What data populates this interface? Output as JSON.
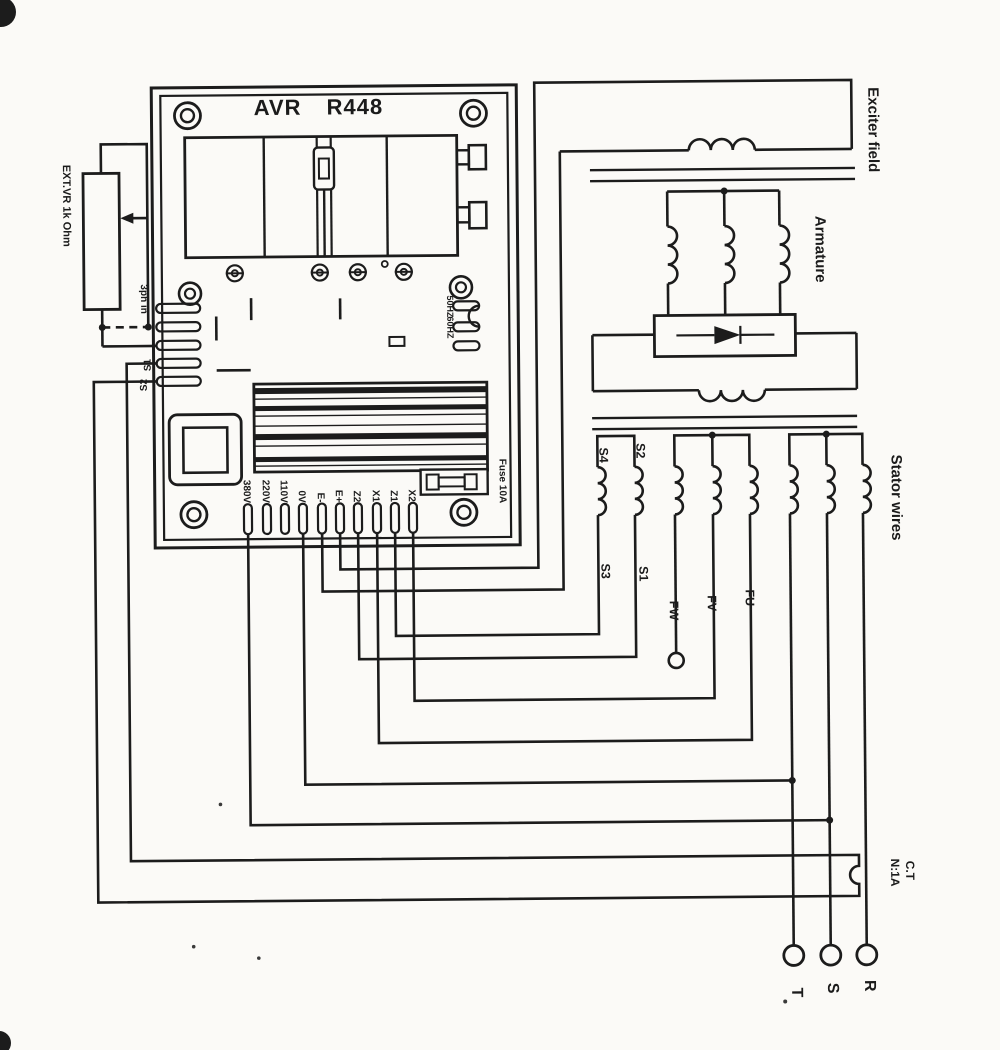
{
  "board": {
    "title": "AVR R448",
    "ext_vr_label": "EXT.VR 1k Ohm",
    "ph_in_label": "3ph in",
    "ct_s1_label": "S1",
    "ct_s2_label": "S2",
    "freq_50": "50HZ",
    "freq_60": "60HZ",
    "fuse_label": "Fuse 10A",
    "bottom_terminals": [
      "380V",
      "220V",
      "110V",
      "0V",
      "E-",
      "E+",
      "Z2",
      "X1",
      "Z1",
      "X2"
    ]
  },
  "generator": {
    "exciter_field_label": "Exciter field",
    "armature_label": "Armature",
    "stator_wires_label": "Stator wires",
    "ct_label_line1": "C.T",
    "ct_label_line2": "N:1A",
    "phase_r": "R",
    "phase_s": "S",
    "phase_t": "T",
    "winding_s4": "S4",
    "winding_s2": "S2",
    "winding_s3": "S3",
    "winding_s1": "S1",
    "winding_fw": "FW",
    "winding_fv": "FV",
    "winding_fu": "FU"
  }
}
